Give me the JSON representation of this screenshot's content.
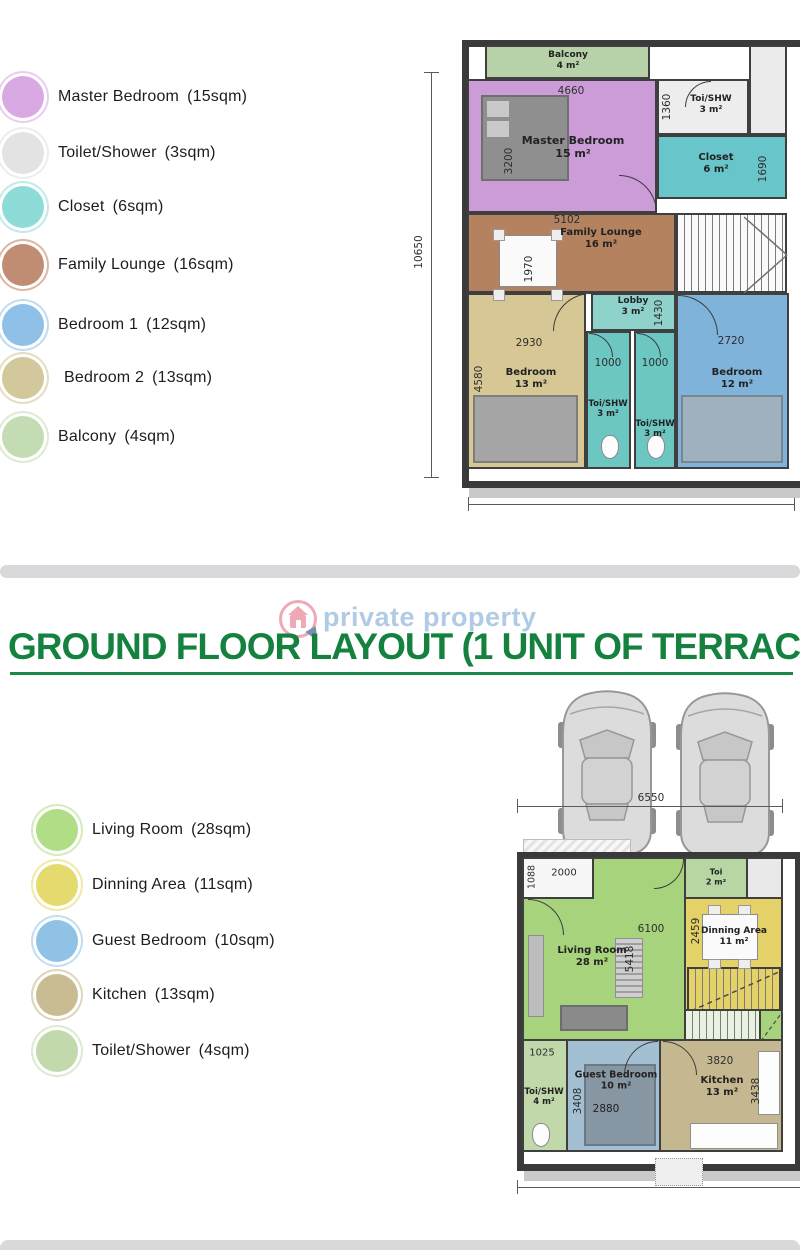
{
  "colors": {
    "title_green": "#15813f",
    "underline_green": "#1c8747",
    "watermark_text_blue": "#a9c6e2",
    "watermark_logo_pink": "#ef9fae",
    "divider_gray": "#d9d9db",
    "wall_dark": "#3a3a3a",
    "legend_first_floor": [
      "#d9a9e3",
      "#e3e3e3",
      "#8edcd8",
      "#c18d72",
      "#8fc0e8",
      "#d3c89b",
      "#c4dcb4"
    ],
    "legend_ground_floor": [
      "#b0dd85",
      "#e4da6d",
      "#8fc2e5",
      "#c9bc92",
      "#c2d9ab"
    ]
  },
  "first_floor": {
    "legend": [
      {
        "name": "Master Bedroom",
        "size": "(15sqm)",
        "color": "#d9a9e3"
      },
      {
        "name": "Toilet/Shower",
        "size": "(3sqm)",
        "color": "#e3e3e3"
      },
      {
        "name": "Closet",
        "size": "(6sqm)",
        "color": "#8edcd8"
      },
      {
        "name": "Family Lounge",
        "size": "(16sqm)",
        "color": "#c18d72"
      },
      {
        "name": "Bedroom 1",
        "size": "(12sqm)",
        "color": "#8fc0e8"
      },
      {
        "name": "Bedroom 2",
        "size": "(13sqm)",
        "color": "#d3c89b"
      },
      {
        "name": "Balcony",
        "size": "(4sqm)",
        "color": "#c4dcb4"
      }
    ],
    "plan": {
      "balcony": {
        "name": "Balcony",
        "area": "4 m²"
      },
      "master": {
        "name": "Master Bedroom",
        "area": "15 m²"
      },
      "toishw_top": {
        "name": "Toi/SHW",
        "area": "3 m²"
      },
      "closet": {
        "name": "Closet",
        "area": "6 m²"
      },
      "family": {
        "name": "Family Lounge",
        "area": "16 m²"
      },
      "lobby": {
        "name": "Lobby",
        "area": "3 m²"
      },
      "bedroom2": {
        "name": "Bedroom",
        "area": "13 m²"
      },
      "bedroom1": {
        "name": "Bedroom",
        "area": "12 m²"
      },
      "toishw_a": {
        "name": "Toi/SHW",
        "area": "3 m²"
      },
      "toishw_b": {
        "name": "Toi/SHW",
        "area": "3 m²"
      },
      "dims": {
        "overall_height": "10650",
        "master_width": "4660",
        "master_height": "3200",
        "toishw_height": "1360",
        "closet_height": "1690",
        "family_width": "5102",
        "family_table": "1970",
        "lobby_height": "1430",
        "bedroom2_width": "2930",
        "bedroom2_height": "4580",
        "bedroom1_width": "2720",
        "toishw_a_width": "1000",
        "toishw_b_width": "1000"
      }
    }
  },
  "ground_floor": {
    "watermark": "private property",
    "title": "GROUND FLOOR LAYOUT (1 UNIT OF TERRACE)",
    "legend": [
      {
        "name": "Living Room",
        "size": "(28sqm)",
        "color": "#b0dd85"
      },
      {
        "name": "Dinning Area",
        "size": "(11sqm)",
        "color": "#e4da6d"
      },
      {
        "name": "Guest Bedroom",
        "size": "(10sqm)",
        "color": "#8fc2e5"
      },
      {
        "name": "Kitchen",
        "size": "(13sqm)",
        "color": "#c9bc92"
      },
      {
        "name": "Toilet/Shower",
        "size": "(4sqm)",
        "color": "#c2d9ab"
      }
    ],
    "plan": {
      "living": {
        "name": "Living Room",
        "area": "28 m²"
      },
      "toi": {
        "name": "Toi",
        "area": "2 m²"
      },
      "dinning": {
        "name": "Dinning Area",
        "area": "11 m²"
      },
      "toishw": {
        "name": "Toi/SHW",
        "area": "4 m²"
      },
      "guest": {
        "name": "Guest Bedroom",
        "area": "10 m²"
      },
      "kitchen": {
        "name": "Kitchen",
        "area": "13 m²"
      },
      "dims": {
        "overall_width": "6550",
        "entry_width": "2000",
        "entry_height": "1088",
        "living_width": "6100",
        "living_height": "5418",
        "dinning_height": "2459",
        "toishw_width": "1025",
        "guest_height": "3408",
        "guest_bed_width": "2880",
        "kitchen_width": "3820",
        "kitchen_height": "3438"
      }
    }
  }
}
